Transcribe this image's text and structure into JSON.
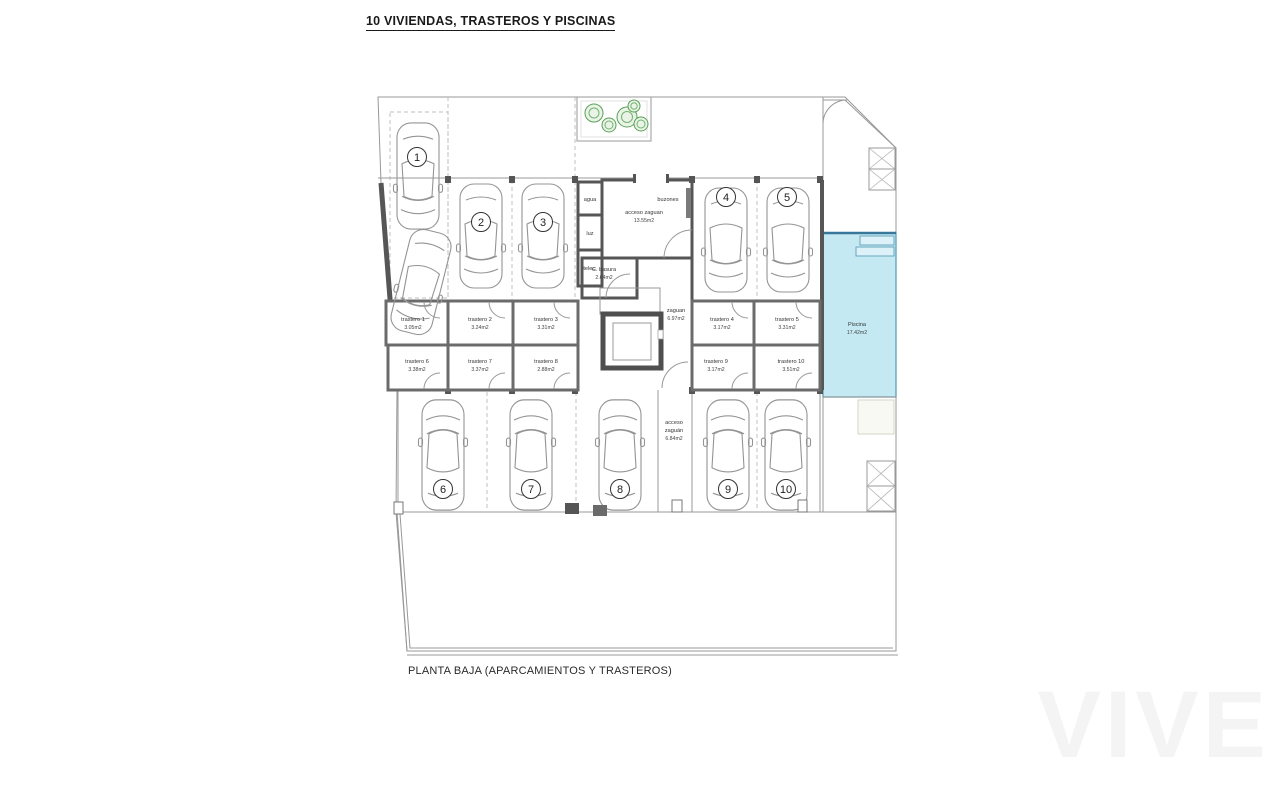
{
  "title": "10 VIVIENDAS, TRASTEROS Y PISCINAS",
  "caption": "PLANTA BAJA (APARCAMIENTOS Y TRASTEROS)",
  "watermark": "VIVE",
  "parking": {
    "spaces": [
      "1",
      "2",
      "3",
      "4",
      "5",
      "6",
      "7",
      "8",
      "9",
      "10"
    ]
  },
  "trasteros": [
    {
      "name": "trastero 1",
      "area": "3.05m2"
    },
    {
      "name": "trastero 2",
      "area": "3.24m2"
    },
    {
      "name": "trastero 3",
      "area": "3.31m2"
    },
    {
      "name": "trastero 4",
      "area": "3.17m2"
    },
    {
      "name": "trastero 5",
      "area": "3.31m2"
    },
    {
      "name": "trastero 6",
      "area": "3.38m2"
    },
    {
      "name": "trastero 7",
      "area": "3.37m2"
    },
    {
      "name": "trastero 8",
      "area": "2.88m2"
    },
    {
      "name": "trastero 9",
      "area": "3.17m2"
    },
    {
      "name": "trastero 10",
      "area": "3.51m2"
    }
  ],
  "core": {
    "agua": "agua",
    "luz": "luz",
    "telec": "telec.",
    "buzones": "buzones",
    "acceso_zaguan": {
      "name": "acceso zaguan",
      "area": "13.55m2"
    },
    "basura": {
      "name": "C. basura",
      "area": "2.64m2"
    },
    "zaguan": {
      "name": "zaguan",
      "area": "6.97m2"
    },
    "acceso_sur": {
      "line1": "acceso",
      "line2": "zaguán",
      "line3": "6.84m2"
    }
  },
  "exterior": {
    "piscina": {
      "name": "Piscina",
      "area": "17.42m2"
    }
  }
}
